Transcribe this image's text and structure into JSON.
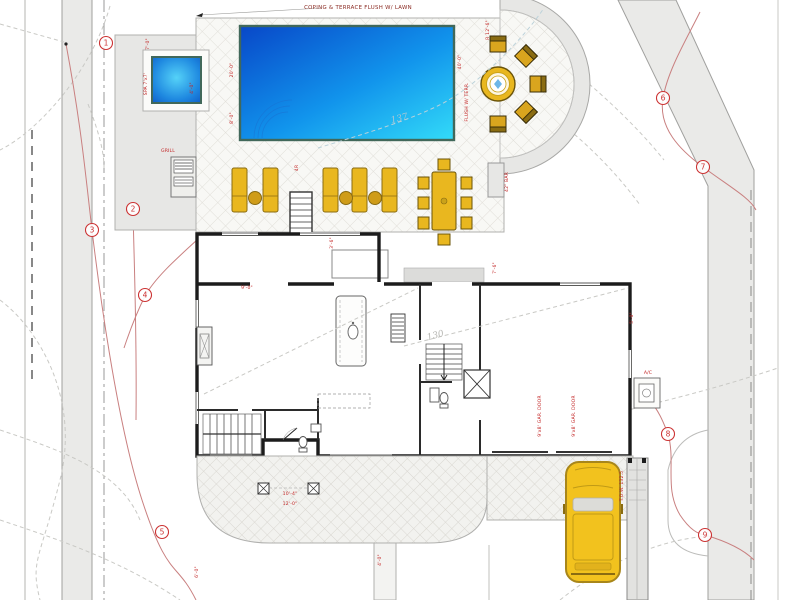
{
  "annotations": {
    "terrace_note": "COPING & TERRACE FLUSH W/ LAWN"
  },
  "contour_labels": [
    {
      "t": "137",
      "x": 400,
      "y": 121,
      "r": -14,
      "c": "#a9c6d4"
    },
    {
      "t": "130",
      "x": 436,
      "y": 338,
      "r": -15,
      "c": "#b6b6b2"
    }
  ],
  "keynotes": [
    {
      "n": "1",
      "x": 106,
      "y": 43
    },
    {
      "n": "2",
      "x": 133,
      "y": 209
    },
    {
      "n": "3",
      "x": 92,
      "y": 230
    },
    {
      "n": "4",
      "x": 145,
      "y": 295
    },
    {
      "n": "5",
      "x": 162,
      "y": 532
    },
    {
      "n": "6",
      "x": 663,
      "y": 98
    },
    {
      "n": "7",
      "x": 703,
      "y": 167
    },
    {
      "n": "8",
      "x": 668,
      "y": 434
    },
    {
      "n": "9",
      "x": 705,
      "y": 535
    }
  ],
  "dims": [
    {
      "t": "20'-0\"",
      "x": 233,
      "y": 70,
      "r": -90
    },
    {
      "t": "8'-0\"",
      "x": 233,
      "y": 118,
      "r": -90
    },
    {
      "t": "7'-0\"",
      "x": 149,
      "y": 44,
      "r": -90
    },
    {
      "t": "SPA 7'x7'",
      "x": 147,
      "y": 84,
      "r": -90
    },
    {
      "t": "4'-0\"",
      "x": 193,
      "y": 88,
      "r": -90
    },
    {
      "t": "40'-0\"",
      "x": 461,
      "y": 62,
      "r": -90
    },
    {
      "t": "FLUSH W/ TERR.",
      "x": 468,
      "y": 102,
      "r": -90
    },
    {
      "t": "R 12'-6\"",
      "x": 489,
      "y": 30,
      "r": -90
    },
    {
      "t": "4R",
      "x": 298,
      "y": 168,
      "r": -90
    },
    {
      "t": "3'-6\"",
      "x": 333,
      "y": 243,
      "r": -90
    },
    {
      "t": "7'-6\"",
      "x": 496,
      "y": 268,
      "r": -90
    },
    {
      "t": "42\" BAR",
      "x": 508,
      "y": 182,
      "r": -90
    },
    {
      "t": "GRILL",
      "x": 168,
      "y": 152,
      "r": 0
    },
    {
      "t": "9'-0\"",
      "x": 247,
      "y": 289,
      "r": 0
    },
    {
      "t": "5'-0\"",
      "x": 633,
      "y": 318,
      "r": -90
    },
    {
      "t": "9'x8' GAR. DOOR",
      "x": 541,
      "y": 416,
      "r": -90
    },
    {
      "t": "9'x8' GAR. DOOR",
      "x": 575,
      "y": 416,
      "r": -90
    },
    {
      "t": "10'-4\"",
      "x": 290,
      "y": 495,
      "r": 0
    },
    {
      "t": "12'-0\"",
      "x": 290,
      "y": 505,
      "r": 0
    },
    {
      "t": "6'-0\"",
      "x": 198,
      "y": 572,
      "r": -90
    },
    {
      "t": "4'-0\"",
      "x": 381,
      "y": 560,
      "r": -90
    },
    {
      "t": "A/C",
      "x": 648,
      "y": 374,
      "r": 0
    },
    {
      "t": "T.O.W. 132.5",
      "x": 623,
      "y": 486,
      "r": -90
    }
  ],
  "colors": {
    "pool_deep": "#0847c8",
    "pool_light": "#33dbf8",
    "pool_border": "#41685a",
    "furniture_gold": "#e9b71f",
    "car_yellow": "#f2c21e",
    "annotation_red": "#c22323",
    "contour_red": "#c98080",
    "wall_black": "#1c1c1c",
    "hardscape_gray": "#e7e7e5"
  }
}
